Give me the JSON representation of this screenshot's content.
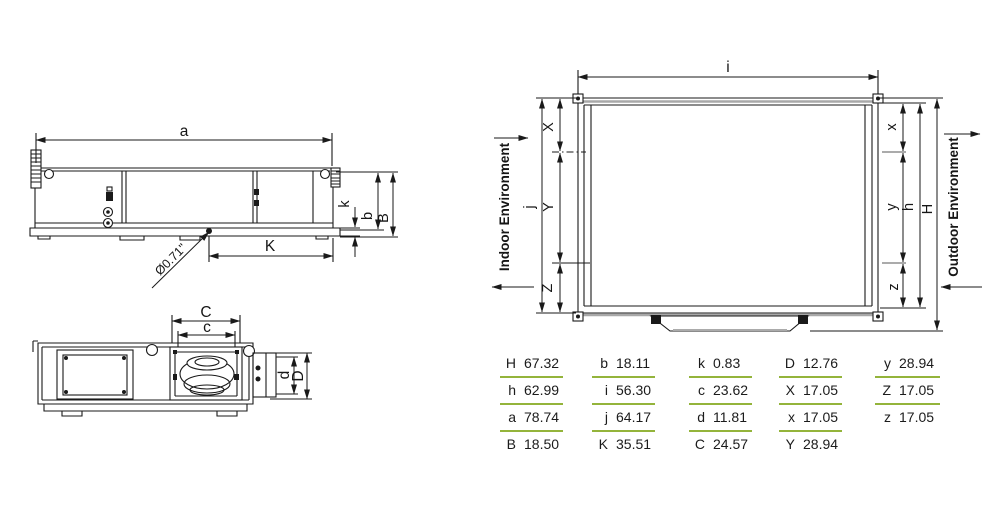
{
  "colors": {
    "line": "#1a1a1a",
    "gray_edge": "#a8a8a8",
    "table_rule_green": "#94b43b"
  },
  "side_view": {
    "labels": {
      "a": "a",
      "K": "K",
      "k": "k",
      "b": "b",
      "B": "B"
    },
    "drain_diameter": "Ø0.71\""
  },
  "bottom_view": {
    "labels": {
      "C": "C",
      "c": "c",
      "d": "d",
      "D": "D"
    }
  },
  "top_view": {
    "labels": {
      "i": "i",
      "j": "j",
      "X": "X",
      "Y": "Y",
      "Z": "Z",
      "x": "x",
      "y": "y",
      "z": "z",
      "h": "h",
      "H": "H"
    },
    "indoor_label": "Indoor Environment",
    "outdoor_label": "Outdoor Environment"
  },
  "dimension_table": {
    "columns": [
      {
        "rows": [
          {
            "label": "H",
            "value": "67.32"
          },
          {
            "label": "h",
            "value": "62.99"
          },
          {
            "label": "a",
            "value": "78.74"
          },
          {
            "label": "B",
            "value": "18.50"
          }
        ]
      },
      {
        "rows": [
          {
            "label": "b",
            "value": "18.11"
          },
          {
            "label": "i",
            "value": "56.30"
          },
          {
            "label": "j",
            "value": "64.17"
          },
          {
            "label": "K",
            "value": "35.51"
          }
        ]
      },
      {
        "rows": [
          {
            "label": "k",
            "value": "0.83"
          },
          {
            "label": "c",
            "value": "23.62"
          },
          {
            "label": "d",
            "value": "11.81"
          },
          {
            "label": "C",
            "value": "24.57"
          }
        ]
      },
      {
        "rows": [
          {
            "label": "D",
            "value": "12.76"
          },
          {
            "label": "X",
            "value": "17.05"
          },
          {
            "label": "x",
            "value": "17.05"
          },
          {
            "label": "Y",
            "value": "28.94"
          }
        ]
      },
      {
        "rows": [
          {
            "label": "y",
            "value": "28.94"
          },
          {
            "label": "Z",
            "value": "17.05"
          },
          {
            "label": "z",
            "value": "17.05"
          }
        ]
      }
    ]
  }
}
